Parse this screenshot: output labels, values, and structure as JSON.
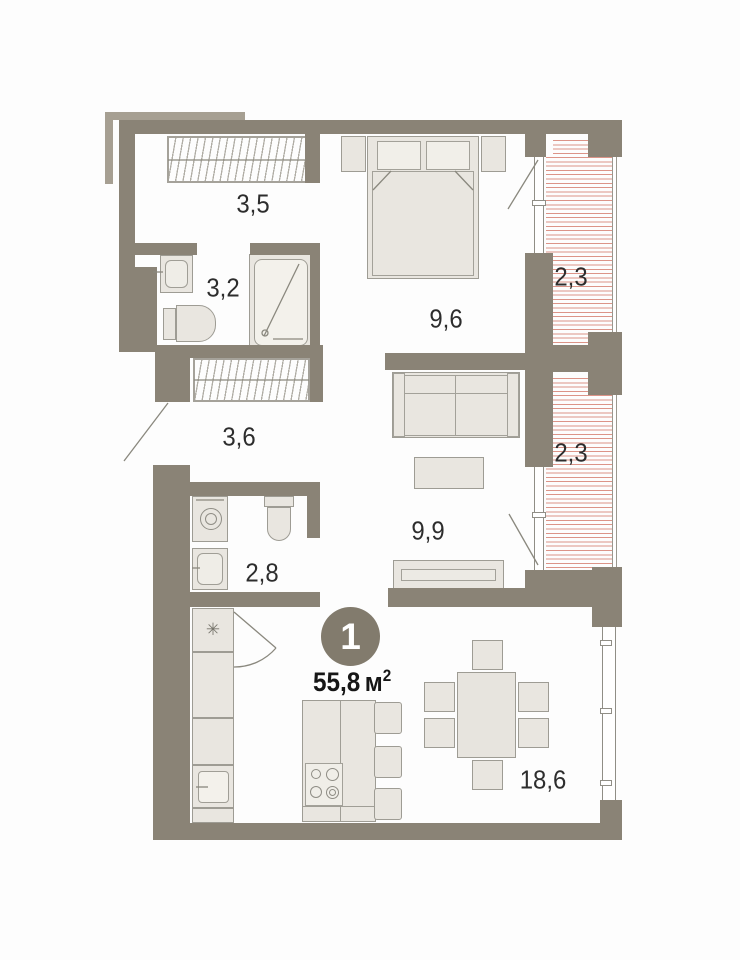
{
  "plan": {
    "badge": {
      "number": "1",
      "area_value": "55,8",
      "area_unit": "м",
      "area_sup": "2"
    },
    "rooms": [
      {
        "id": "dressing-room",
        "label": "3,5"
      },
      {
        "id": "bathroom",
        "label": "3,2"
      },
      {
        "id": "bedroom",
        "label": "9,6"
      },
      {
        "id": "balcony-upper",
        "label": "2,3"
      },
      {
        "id": "hallway",
        "label": "3,6"
      },
      {
        "id": "balcony-lower",
        "label": "2,3"
      },
      {
        "id": "living-room",
        "label": "9,9"
      },
      {
        "id": "laundry-wc",
        "label": "2,8"
      },
      {
        "id": "kitchen-dining",
        "label": "18,6"
      }
    ],
    "symbols": {
      "fridge": "✳"
    },
    "colors": {
      "wall": "#8a8376",
      "wall_light": "#a69f92",
      "furniture_fill": "#e9e6e0",
      "furniture_stroke": "#9e9c94",
      "balcony_hatch": "#dc9488",
      "badge_fill": "#827b6d",
      "label_text": "#2d2d2d"
    }
  }
}
